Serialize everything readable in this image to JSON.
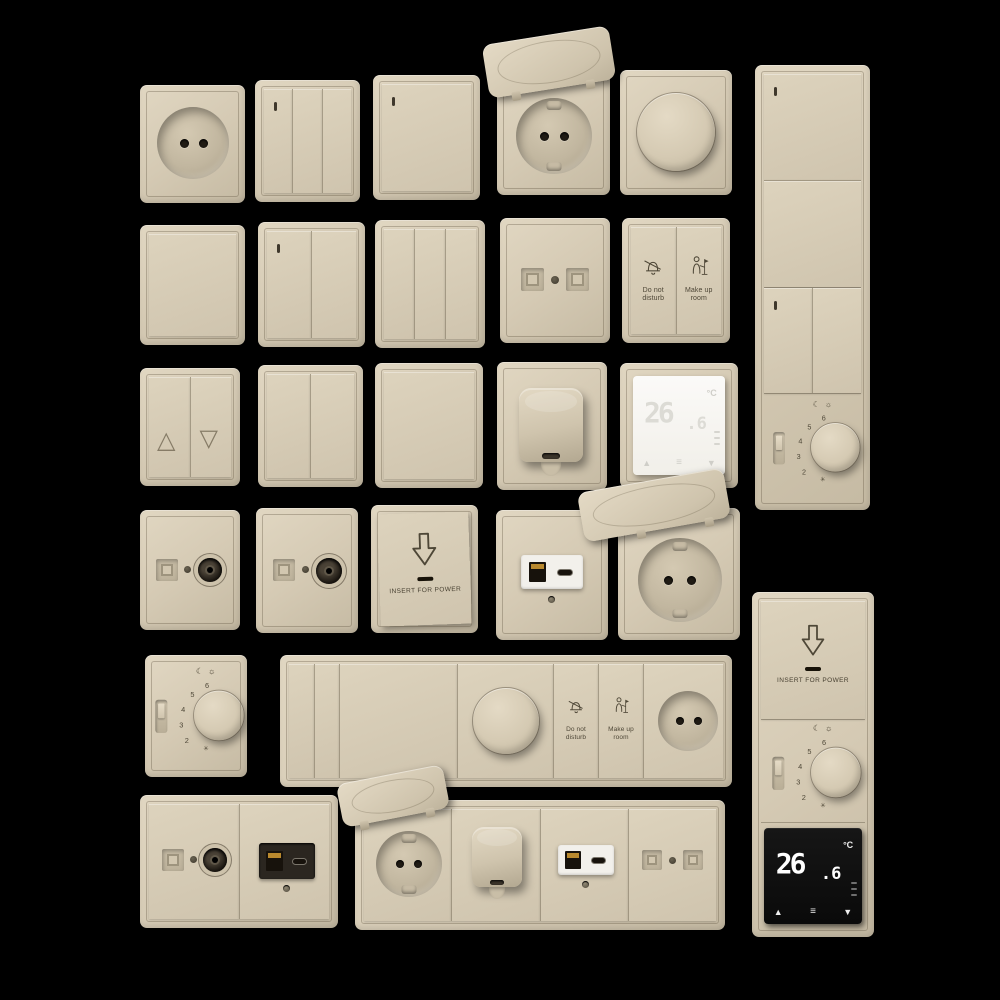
{
  "scene": {
    "background": "#000000",
    "description": "beige hotel wall switch, socket and thermostat collection on black"
  },
  "colors": {
    "plate_beige": "#d5cab4",
    "plate_shadow": "#b3a891",
    "engraving": "#4e4737",
    "port_black": "#201b14",
    "usb_gold": "#b9892e",
    "white_insert": "#f2f0eb",
    "dark_insert": "#2b2620",
    "thermo_white_bg": "#f7f6f3",
    "thermo_white_digits": "#dcdbd5",
    "thermo_black_bg": "#0d0d0d",
    "thermo_black_digits": "#ffffff"
  },
  "glyphs": {
    "blinds_up": "△",
    "blinds_down": "▽",
    "thermo_up": "▲",
    "thermo_down": "▼",
    "thermo_menu": "≡",
    "dial_moon": "☾",
    "dial_sun": "☼",
    "dial_frost": "✳"
  },
  "labels": {
    "dnd_line1": "Do not",
    "dnd_line2": "disturb",
    "mur_line1": "Make up",
    "mur_line2": "room",
    "insert_for_power": "INSERT FOR POWER"
  },
  "thermostat": {
    "temperature": "26.6",
    "display_int": "26",
    "display_frac": ".6",
    "unit": "°C"
  },
  "dial": {
    "numbers": [
      "6",
      "5",
      "4",
      "3",
      "2"
    ]
  }
}
